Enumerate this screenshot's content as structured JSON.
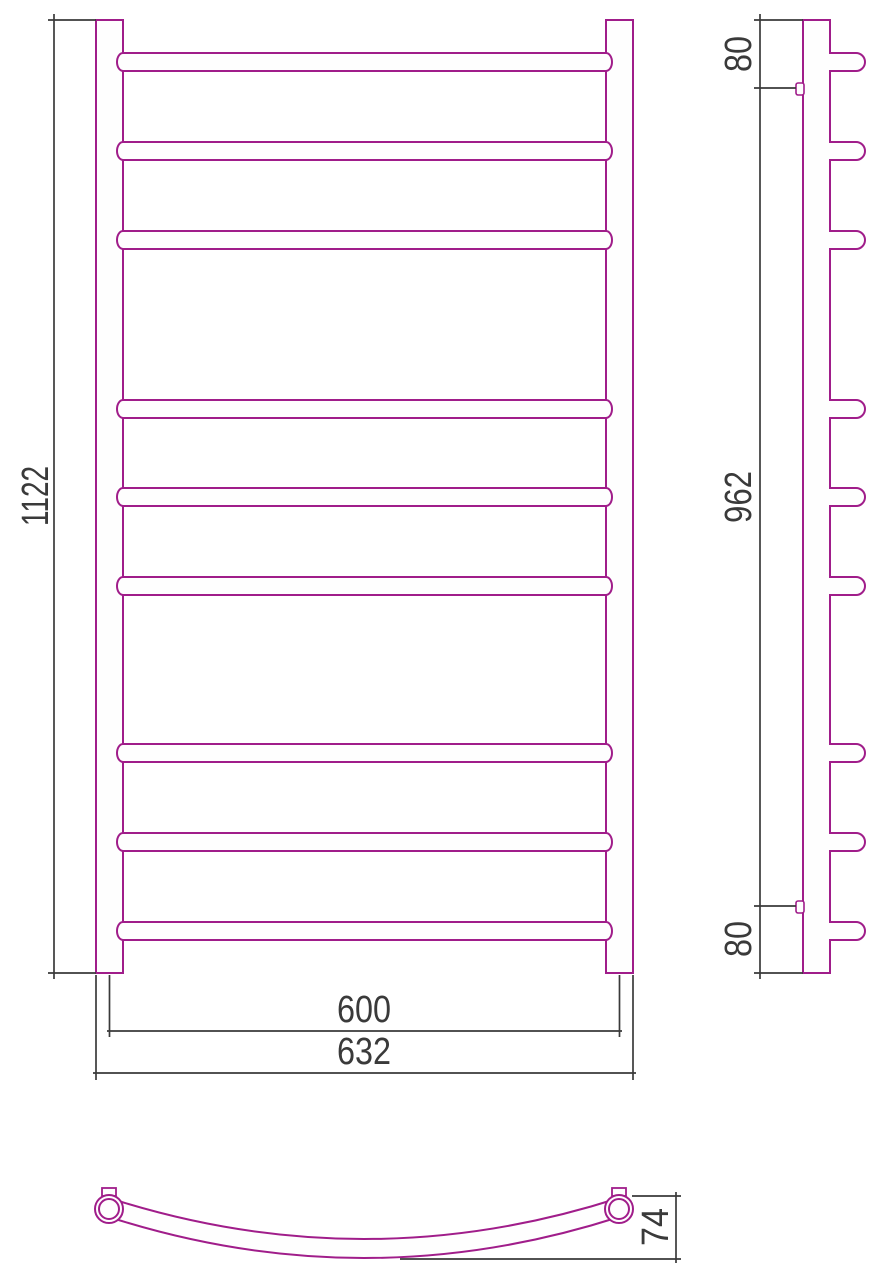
{
  "drawing_type": "towel-rail-technical-drawing",
  "colors": {
    "outline": "#a01d8a",
    "dimension": "#3a3a3a",
    "background": "#ffffff"
  },
  "front_view": {
    "height_label": "1122",
    "width_center_label": "600",
    "width_overall_label": "632",
    "rung_count": 9,
    "rung_centers_y": [
      62,
      151,
      240,
      409,
      497,
      586,
      753,
      842,
      931
    ],
    "post_top_y": 20,
    "post_bottom_y": 973,
    "left_post_x": 96,
    "right_post_x": 606,
    "post_width": 27,
    "rung_half_height": 9
  },
  "side_view": {
    "top_offset_label": "80",
    "bracket_span_label": "962",
    "bottom_offset_label": "80",
    "tube_x": 803,
    "tube_width": 27,
    "bracket_y_top": 83,
    "bracket_y_bottom": 901
  },
  "top_view": {
    "bow_depth_label": "74",
    "left_hub_center_x": 109,
    "right_hub_center_x": 619,
    "hub_center_y": 1209,
    "hub_outer_r": 14,
    "hub_inner_r": 10
  }
}
